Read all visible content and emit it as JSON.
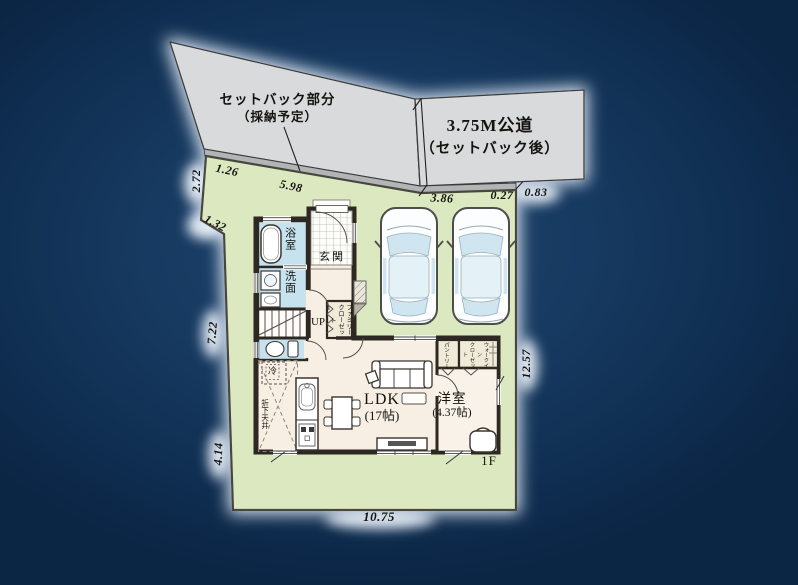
{
  "road": {
    "setback_area_line1": "セットバック部分",
    "setback_area_line2": "（採納予定）",
    "road_width_line1": "3.75M公道",
    "road_width_line2": "（セットバック後）"
  },
  "dims": {
    "a126": "1.26",
    "a598": "5.98",
    "a272": "2.72",
    "a132": "1.32",
    "a386": "3.86",
    "a027": "0.27",
    "a083": "0.83",
    "a1257": "12.57",
    "a722": "7.22",
    "a414": "4.14",
    "a1075": "10.75"
  },
  "plan": {
    "floor": "1F",
    "bath": "浴室",
    "washroom": "洗面",
    "entrance": "玄関",
    "stairs_up": "UP",
    "family_closet": "ファミリー\nクローゼット",
    "fridge": "冷",
    "lowered_ceiling": "折下天井",
    "ldk_name": "LDK",
    "ldk_size": "(17帖)",
    "western_name": "洋室",
    "western_size": "(4.37帖)",
    "pantry": "パントリー",
    "walk_in_closet": "ウォークイン\nクローゼット"
  },
  "colors": {
    "background": "#14355c",
    "road": "#d9dadb",
    "setback_strip": "#b2b4b6",
    "lot_green": "#dbe8c0",
    "floor_cream": "#f7efe4",
    "wet_room_blue": "#c5e2ee",
    "wall_dark": "#2e2822",
    "car_window_blue": "#cfe6f1"
  }
}
